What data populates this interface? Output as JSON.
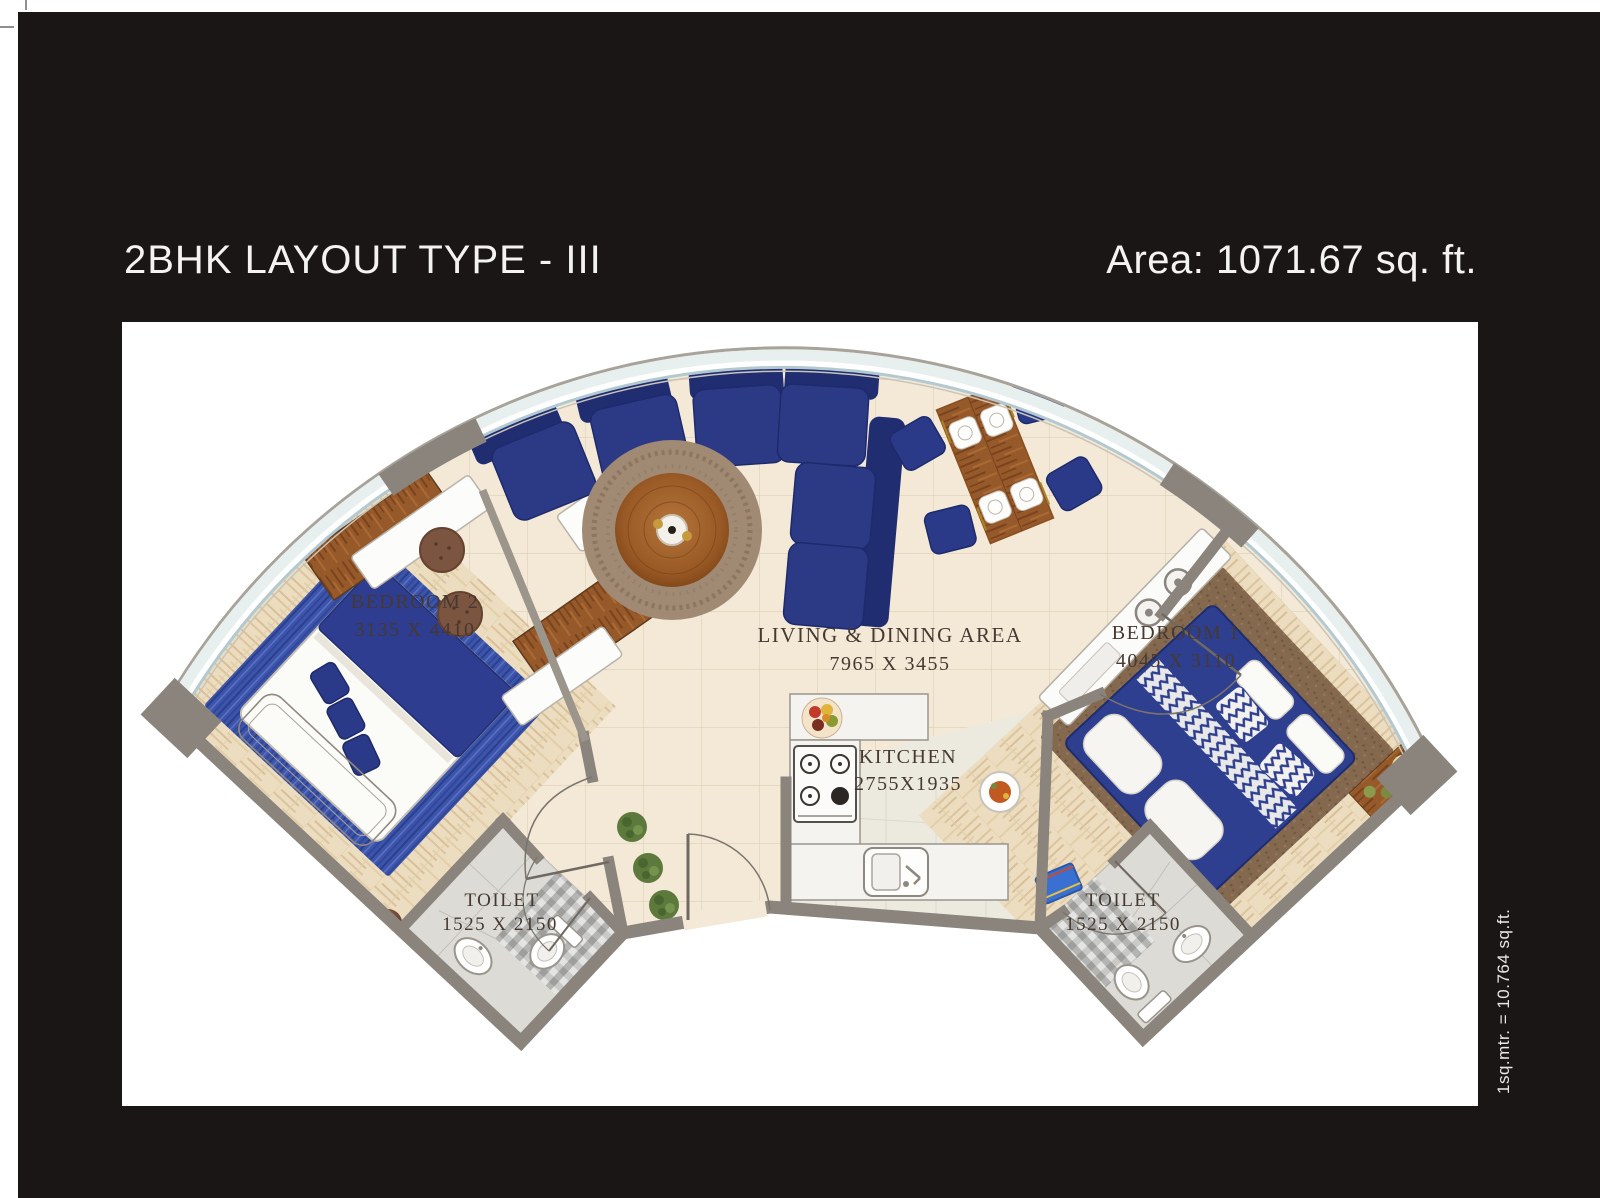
{
  "header": {
    "title": "2BHK LAYOUT TYPE - III",
    "area_label": "Area: 1071.67 sq. ft."
  },
  "footnote": {
    "scale_note": "1sq.mtr. = 10.764 sq.ft."
  },
  "floorplan": {
    "rooms": [
      {
        "id": "bedroom2",
        "name": "BEDROOM 2",
        "dimensions": "3135 X 4410"
      },
      {
        "id": "living_dining",
        "name": "LIVING & DINING AREA",
        "dimensions": "7965 X 3455"
      },
      {
        "id": "bedroom1",
        "name": "BEDROOM 1",
        "dimensions": "4045 X 3110"
      },
      {
        "id": "kitchen",
        "name": "KITCHEN",
        "dimensions": "2755X1935"
      },
      {
        "id": "toilet_left",
        "name": "TOILET",
        "dimensions": "1525 X 2150"
      },
      {
        "id": "toilet_right",
        "name": "TOILET",
        "dimensions": "1525 X 2150"
      }
    ],
    "colors": {
      "frame_black": "#191615",
      "floor_cream": "#f3e9d6",
      "wall_gray": "#8a847c",
      "glass_blue": "#b3c9d1",
      "sofa_navy": "#2c3a86",
      "wood_light": "#ecddc0",
      "wood_dark": "#96592a",
      "rug_brown": "#a08a74",
      "label_brown": "#453931"
    }
  }
}
